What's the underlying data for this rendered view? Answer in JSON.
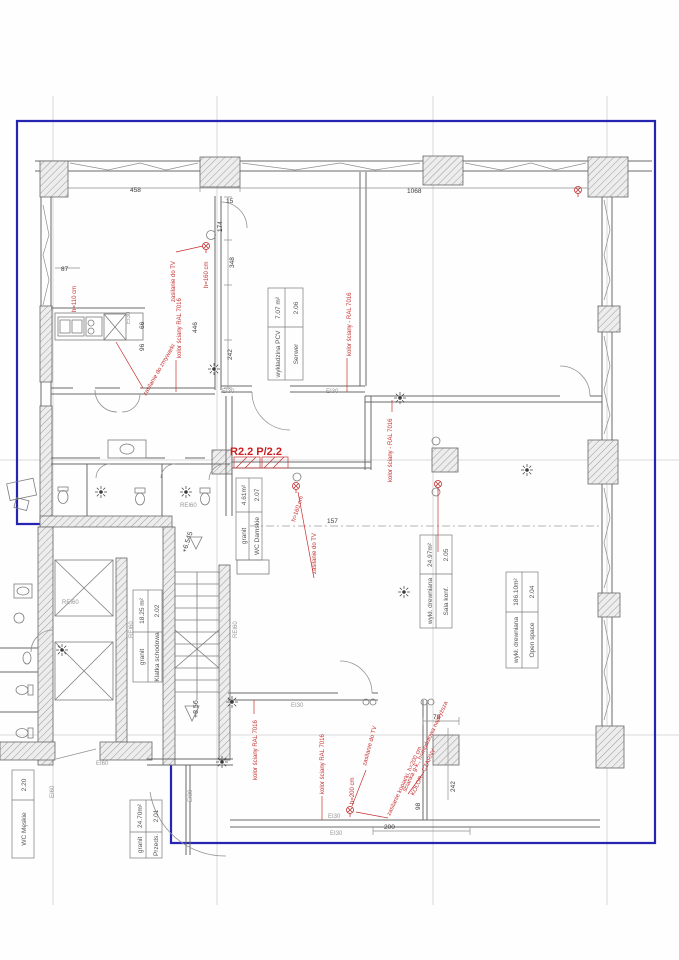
{
  "drawing_kind": "architectural floor plan (2nd storey office fit-out)",
  "zone_label": "R2.2 P/2.2",
  "rooms": [
    {
      "number": "2.01",
      "name": "Przeds.",
      "area": "24.70m²",
      "floor": "granit"
    },
    {
      "number": "2.02",
      "name": "Klatka schodowa",
      "area": "18.25 m²",
      "floor": "granit"
    },
    {
      "number": "2.04",
      "name": "Open space",
      "area": "186.10m²",
      "floor": "wykł. drewniana"
    },
    {
      "number": "2.05",
      "name": "Sala konf.",
      "area": "24.97m²",
      "floor": "wykł. drewniana"
    },
    {
      "number": "2.06",
      "name": "Serwer",
      "area": "7.07 m²",
      "floor": "wykładzina PCV"
    },
    {
      "number": "2.07",
      "name": "WC Damskie",
      "area": "4.61m²",
      "floor": "granit"
    },
    {
      "number": "2.20",
      "name": "WC Męskie",
      "area": "",
      "floor": ""
    }
  ],
  "red_notes": {
    "zasilanie_tv": "zasilanie do TV",
    "h160": "h=160 cm",
    "h200": "h=200 cm",
    "h110": "h=110 cm",
    "kolor_sciany": "kolor ściany RAL 7016",
    "kolor_sciany_dash": "kolor ściany - RAL 7016",
    "zmywarka": "zasilanie do zmywarki",
    "kopiarka": "zasilanie kopiarki, h=200 cm",
    "scianka1": "ścianka g-k., h=modułowa najwyższa",
    "scianka2": "KOLOR - CZARNY"
  },
  "dimensions": {
    "top_left": "458",
    "top_right": "1068",
    "d15": "15",
    "d174": "174",
    "d348": "348",
    "d87": "87",
    "d446": "446",
    "d242a": "242",
    "d66": "66",
    "d96": "96",
    "d157": "157",
    "d78": "78",
    "d242b": "242",
    "d98": "98",
    "d200": "200"
  },
  "fire_ratings": {
    "ei30": "EI30",
    "ei60": "EI60",
    "rei60": "REI60"
  },
  "elevations": {
    "upper": "+6.545",
    "lower": "+8.56"
  },
  "colors": {
    "boundary": "#2525b2",
    "annotation": "#c43030",
    "wall": "#6a6a6a",
    "axis": "#cfcfcf"
  }
}
